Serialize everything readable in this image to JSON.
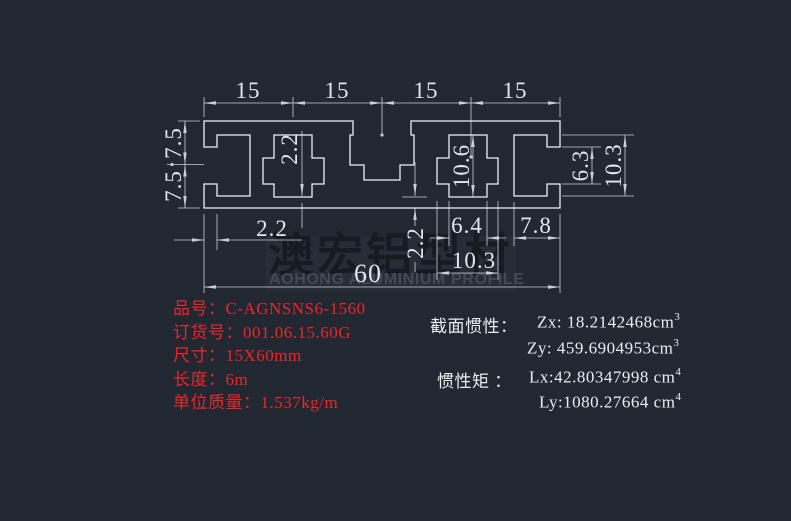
{
  "colors": {
    "background": "#222831",
    "profile_line": "#eef1f5",
    "dimension_line": "#c9cfd7",
    "dimension_text": "#e2e6ec",
    "product_text_red": "#ed2428",
    "property_text_white": "#e9ecf0",
    "watermark_panel": "#272d37"
  },
  "dims": {
    "w1": "15",
    "w2": "15",
    "w3": "15",
    "w4": "15",
    "h1": "7.5",
    "h2": "7.5",
    "slot_open": "6.3",
    "slot_cavity": "10.3",
    "wall_top": "2.2",
    "cavity_h": "10.6",
    "wall_bottom": "2.2",
    "lip": "2.2",
    "neck": "6.4",
    "slot_depth": "7.8",
    "cavity_w": "10.3",
    "total_w": "60"
  },
  "product": {
    "rows": [
      {
        "label": "品号：",
        "value": "C-AGNSNS6-1560"
      },
      {
        "label": "订货号：",
        "value": "001.06.15.60G"
      },
      {
        "label": "尺寸：",
        "value": "15X60mm"
      },
      {
        "label": "长度：",
        "value": "6m"
      },
      {
        "label": "单位质量：",
        "value": "1.537kg/m"
      }
    ]
  },
  "section": {
    "inertia_label": "截面惯性：",
    "zx_text": "Zx: 18.2142468cm",
    "zx_sup": "3",
    "zy_text": "Zy: 459.6904953cm",
    "zy_sup": "3",
    "moment_label": "惯性矩 ：",
    "lx_text": "Lx:42.80347998 cm",
    "lx_sup": "4",
    "ly_text": "Ly:1080.27664 cm",
    "ly_sup": "4"
  },
  "watermark": {
    "zh": "澳宏铝型材",
    "en": "AOHONG ALUMINIUM PROFILE"
  }
}
